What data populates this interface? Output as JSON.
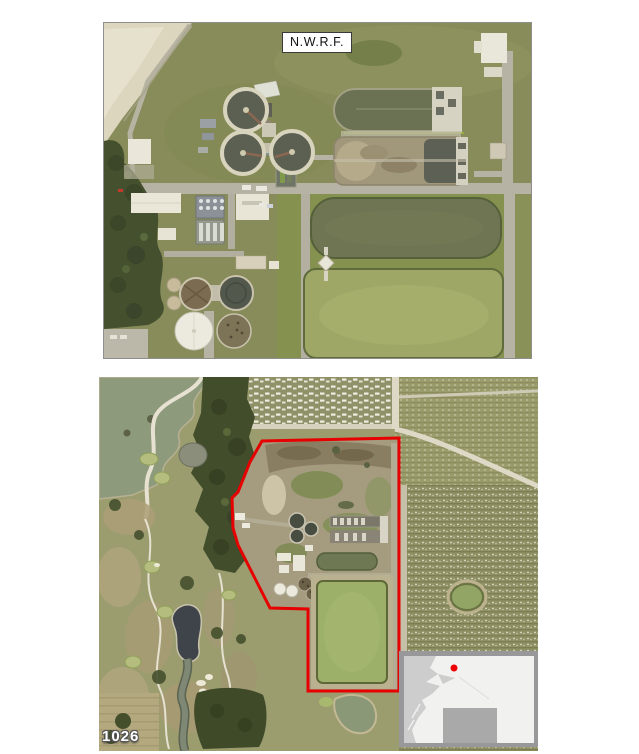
{
  "top_photo": {
    "label": "N.W.R.F."
  },
  "bottom_photo": {
    "corner_label": "1026",
    "boundary_color": "#e60000",
    "inset_map": {
      "marker_color": "#ee0000"
    }
  }
}
